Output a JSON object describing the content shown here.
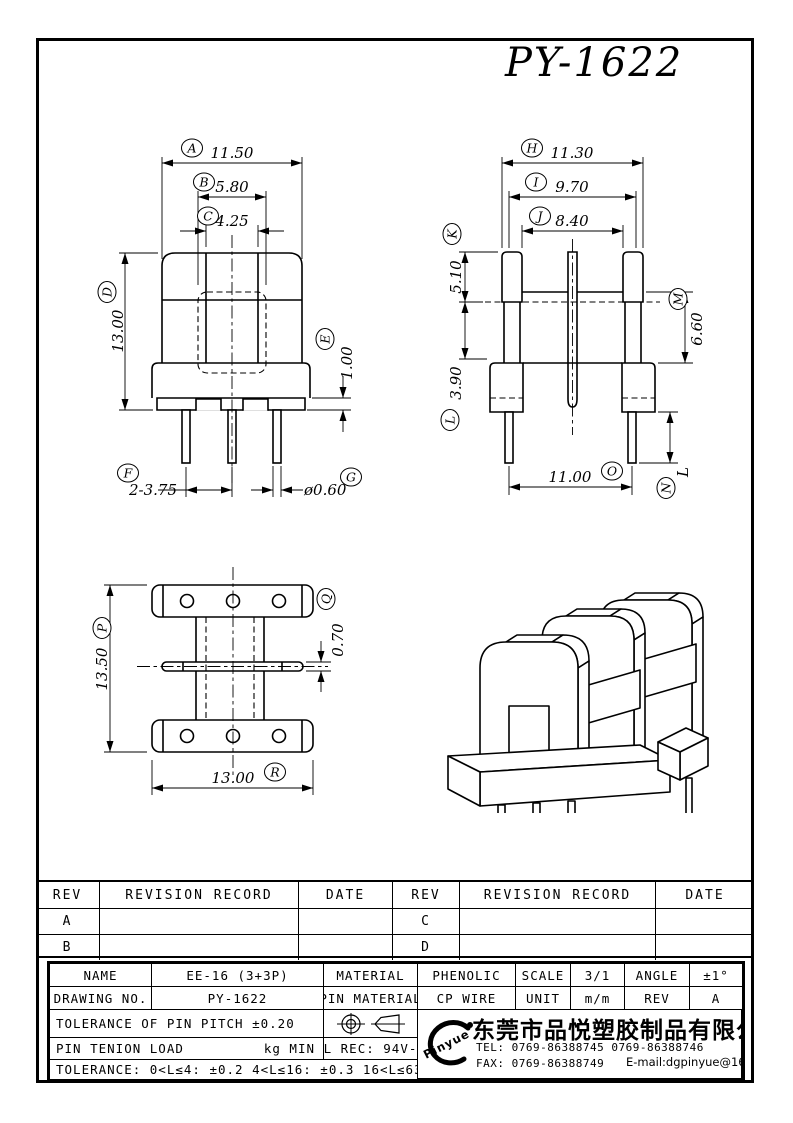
{
  "title": "PY-1622",
  "dims": {
    "front": {
      "A": {
        "letter": "A",
        "value": "11.50"
      },
      "B": {
        "letter": "B",
        "value": "5.80"
      },
      "C": {
        "letter": "C",
        "value": "4.25"
      },
      "D": {
        "letter": "D",
        "value": "13.00"
      },
      "E": {
        "letter": "E",
        "value": "1.00"
      },
      "F": {
        "letter": "F",
        "value": "2-3.75"
      },
      "G": {
        "letter": "G",
        "value": "ø0.60"
      }
    },
    "side": {
      "H": {
        "letter": "H",
        "value": "11.30"
      },
      "I": {
        "letter": "I",
        "value": "9.70"
      },
      "J": {
        "letter": "J",
        "value": "8.40"
      },
      "K": {
        "letter": "K",
        "value": "5.10"
      },
      "L": {
        "letter": "L",
        "value": "3.90"
      },
      "M": {
        "letter": "M",
        "value": "6.60"
      },
      "N": {
        "letter": "N",
        "value": "L"
      },
      "O": {
        "letter": "O",
        "value": "11.00"
      }
    },
    "top": {
      "P": {
        "letter": "P",
        "value": "13.50"
      },
      "Q": {
        "letter": "Q",
        "value": "0.70"
      },
      "R": {
        "letter": "R",
        "value": "13.00"
      }
    }
  },
  "revision_table": {
    "rev_header": "REV",
    "record_header": "REVISION RECORD",
    "date_header": "DATE",
    "rows": [
      {
        "left_rev": "A",
        "left_record": "",
        "left_date": "",
        "right_rev": "C",
        "right_record": "",
        "right_date": ""
      },
      {
        "left_rev": "B",
        "left_record": "",
        "left_date": "",
        "right_rev": "D",
        "right_record": "",
        "right_date": ""
      }
    ]
  },
  "title_block": {
    "name_label": "NAME",
    "name_value": "EE-16 (3+3P)",
    "material_label": "MATERIAL",
    "material_value": "PHENOLIC",
    "scale_label": "SCALE",
    "scale_value": "3/1",
    "angle_label": "ANGLE",
    "angle_value": "±1°",
    "drawing_no_label": "DRAWING NO.",
    "drawing_no_value": "PY-1622",
    "pin_material_label": "PIN MATERIAL",
    "pin_material_value": "CP WIRE",
    "unit_label": "UNIT",
    "unit_value": "m/m",
    "rev_label": "REV",
    "rev_value": "A",
    "pin_pitch_tolerance": "TOLERANCE OF PIN PITCH ±0.20",
    "pin_tension_label": "PIN TENION LOAD",
    "pin_tension_unit": "kg MIN",
    "ul_rec": "UL REC: 94V-0",
    "length_tolerance": "TOLERANCE: 0<L≤4: ±0.2  4<L≤16: ±0.3  16<L≤63: ±0.4",
    "company": {
      "logo": "Pinyue",
      "name": "东莞市品悦塑胶制品有限公司",
      "tel": "TEL: 0769-86388745    0769-86388746",
      "fax": "FAX: 0769-86388749",
      "email": "E-mail:dgpinyue@163.com"
    }
  }
}
